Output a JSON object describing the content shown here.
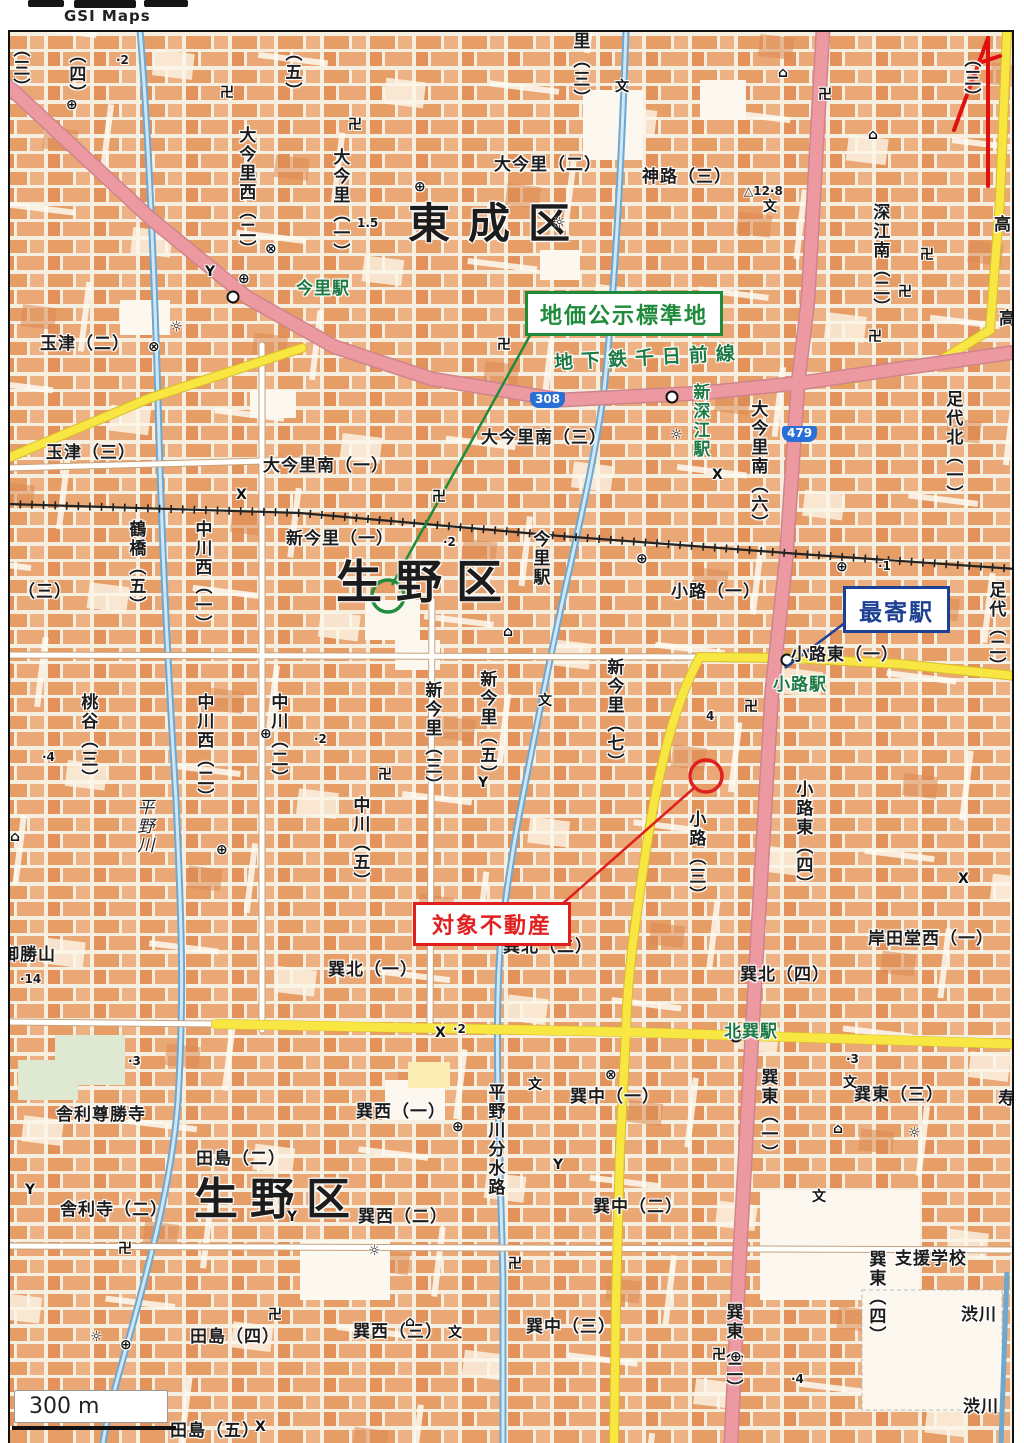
{
  "header": {
    "logo_text": "GSI Maps"
  },
  "annotations": {
    "standard_site": {
      "label": "地価公示標準地",
      "color": "#1f8b3b"
    },
    "nearest_station": {
      "label": "最寄駅",
      "color": "#1d3f94"
    },
    "subject_property": {
      "label": "対象不動産",
      "color": "#e01f1f"
    }
  },
  "scale_bar": {
    "label": "300 m"
  },
  "map": {
    "colors": {
      "major_road": "#ec99a2",
      "secondary_road": "#f8e643",
      "water": "#6fa8cf",
      "city_block": "#e79d66",
      "station_text": "#1e7a45",
      "annotation_green": "#1f8b3b",
      "annotation_navy": "#1d3f94",
      "annotation_red": "#e01f1f"
    },
    "ward_names": [
      "東成区",
      "生野区"
    ],
    "railway_line": "地下鉄千日前線",
    "route_shields": [
      "308",
      "479"
    ],
    "stations": [
      "今里駅",
      "新深江駅",
      "小路駅",
      "北巽駅"
    ],
    "labels": [
      {
        "t": "（三）",
        "x": 10,
        "y": 40,
        "c": "v"
      },
      {
        "t": "（四）",
        "x": 66,
        "y": 46,
        "c": "v"
      },
      {
        "t": "·2",
        "x": 116,
        "y": 54,
        "c": "spot"
      },
      {
        "t": "（五）",
        "x": 282,
        "y": 44,
        "c": "v"
      },
      {
        "t": "里（三）",
        "x": 570,
        "y": 32,
        "c": "v"
      },
      {
        "t": "（三）",
        "x": 961,
        "y": 50,
        "c": "v"
      },
      {
        "t": "大今里西（二）",
        "x": 236,
        "y": 126,
        "c": "v"
      },
      {
        "t": "大今里（一）",
        "x": 330,
        "y": 148,
        "c": "v"
      },
      {
        "t": "大今里（二）",
        "x": 494,
        "y": 156
      },
      {
        "t": "神路（三）",
        "x": 642,
        "y": 168
      },
      {
        "t": "△12·8",
        "x": 744,
        "y": 185,
        "c": "spot"
      },
      {
        "t": "東成区",
        "x": 408,
        "y": 201,
        "c": "big",
        "s": 42,
        "ls": 18
      },
      {
        "t": "1.5",
        "x": 357,
        "y": 217,
        "c": "spot"
      },
      {
        "t": "深江南（二）",
        "x": 870,
        "y": 203,
        "c": "v"
      },
      {
        "t": "高",
        "x": 994,
        "y": 216
      },
      {
        "t": "高",
        "x": 999,
        "y": 310
      },
      {
        "t": "今里駅",
        "x": 296,
        "y": 280,
        "c": "green"
      },
      {
        "t": "玉津（二）",
        "x": 40,
        "y": 335
      },
      {
        "t": "地下鉄千日前線",
        "x": 554,
        "y": 348,
        "c": "green",
        "s": 19,
        "ls": 8,
        "r": -3
      },
      {
        "t": "大今里南（三）",
        "x": 481,
        "y": 429
      },
      {
        "t": "新深江駅",
        "x": 690,
        "y": 383,
        "c": "green v"
      },
      {
        "t": "大今里南（六）",
        "x": 748,
        "y": 400,
        "c": "v"
      },
      {
        "t": "玉津（三）",
        "x": 46,
        "y": 444
      },
      {
        "t": "大今里南（一）",
        "x": 263,
        "y": 457
      },
      {
        "t": "足代北（一）",
        "x": 943,
        "y": 390,
        "c": "v"
      },
      {
        "t": "鶴橋（五）",
        "x": 126,
        "y": 520,
        "c": "v"
      },
      {
        "t": "中川西（一）",
        "x": 192,
        "y": 520,
        "c": "v"
      },
      {
        "t": "新今里（一）",
        "x": 286,
        "y": 530
      },
      {
        "t": "·2",
        "x": 443,
        "y": 536,
        "c": "spot"
      },
      {
        "t": "生野区",
        "x": 336,
        "y": 558,
        "c": "big",
        "s": 46,
        "ls": 14
      },
      {
        "t": "今里駅",
        "x": 530,
        "y": 530,
        "c": "v"
      },
      {
        "t": "（三）",
        "x": 18,
        "y": 583
      },
      {
        "t": "小路（一）",
        "x": 671,
        "y": 583
      },
      {
        "t": "·1",
        "x": 878,
        "y": 560,
        "c": "spot"
      },
      {
        "t": "足代（二）",
        "x": 986,
        "y": 581,
        "c": "v"
      },
      {
        "t": "小路東（一）",
        "x": 791,
        "y": 646
      },
      {
        "t": "小路駅",
        "x": 773,
        "y": 676,
        "c": "green"
      },
      {
        "t": "桃谷（三）",
        "x": 78,
        "y": 693,
        "c": "v"
      },
      {
        "t": "·4",
        "x": 42,
        "y": 751,
        "c": "spot"
      },
      {
        "t": "中川西（二）",
        "x": 194,
        "y": 693,
        "c": "v"
      },
      {
        "t": "中川（二）",
        "x": 268,
        "y": 693,
        "c": "v"
      },
      {
        "t": "新今里（三）",
        "x": 422,
        "y": 681,
        "c": "v"
      },
      {
        "t": "新今里（五）",
        "x": 477,
        "y": 670,
        "c": "v"
      },
      {
        "t": "新今里（七）",
        "x": 604,
        "y": 658,
        "c": "v"
      },
      {
        "t": "·2",
        "x": 314,
        "y": 733,
        "c": "spot"
      },
      {
        "t": "4",
        "x": 706,
        "y": 710,
        "c": "spot"
      },
      {
        "t": "平野川",
        "x": 134,
        "y": 798,
        "c": "river v"
      },
      {
        "t": "中川（五）",
        "x": 350,
        "y": 796,
        "c": "v"
      },
      {
        "t": "小路（三）",
        "x": 686,
        "y": 810,
        "c": "v"
      },
      {
        "t": "小路東（四）",
        "x": 793,
        "y": 780,
        "c": "v"
      },
      {
        "t": "御勝山",
        "x": 2,
        "y": 946
      },
      {
        "t": "·14",
        "x": 20,
        "y": 973,
        "c": "spot"
      },
      {
        "t": "巽北（二）",
        "x": 503,
        "y": 938
      },
      {
        "t": "巽北（一）",
        "x": 328,
        "y": 961
      },
      {
        "t": "巽北（四）",
        "x": 740,
        "y": 966
      },
      {
        "t": "岸田堂西（一）",
        "x": 868,
        "y": 930
      },
      {
        "t": "·2",
        "x": 453,
        "y": 1023,
        "c": "spot"
      },
      {
        "t": "北巽駅",
        "x": 724,
        "y": 1023,
        "c": "green"
      },
      {
        "t": "·3",
        "x": 846,
        "y": 1053,
        "c": "spot"
      },
      {
        "t": "·3",
        "x": 128,
        "y": 1055,
        "c": "spot"
      },
      {
        "t": "巽中（一）",
        "x": 570,
        "y": 1088
      },
      {
        "t": "巽東（三）",
        "x": 854,
        "y": 1086
      },
      {
        "t": "巽東（一）",
        "x": 758,
        "y": 1068,
        "c": "v"
      },
      {
        "t": "寿",
        "x": 998,
        "y": 1090
      },
      {
        "t": "巽西（一）",
        "x": 356,
        "y": 1103
      },
      {
        "t": "舎利尊勝寺",
        "x": 56,
        "y": 1106
      },
      {
        "t": "田島（二）",
        "x": 196,
        "y": 1150
      },
      {
        "t": "生野区",
        "x": 194,
        "y": 1176,
        "c": "big",
        "s": 44,
        "ls": 12
      },
      {
        "t": "巽西（二）",
        "x": 358,
        "y": 1208
      },
      {
        "t": "平野川分水路",
        "x": 485,
        "y": 1083,
        "c": "v"
      },
      {
        "t": "舎利寺（二）",
        "x": 60,
        "y": 1201
      },
      {
        "t": "巽中（二）",
        "x": 593,
        "y": 1198
      },
      {
        "t": "支援学校",
        "x": 895,
        "y": 1250
      },
      {
        "t": "巽東（四）",
        "x": 866,
        "y": 1250,
        "c": "v"
      },
      {
        "t": "巽東（二）",
        "x": 723,
        "y": 1303,
        "c": "v"
      },
      {
        "t": "渋川",
        "x": 961,
        "y": 1306
      },
      {
        "t": "田島（四）",
        "x": 190,
        "y": 1328
      },
      {
        "t": "巽西（三）",
        "x": 353,
        "y": 1323
      },
      {
        "t": "巽中（三）",
        "x": 526,
        "y": 1318
      },
      {
        "t": "·4",
        "x": 791,
        "y": 1373,
        "c": "spot"
      },
      {
        "t": "渋川",
        "x": 963,
        "y": 1398
      },
      {
        "t": "田島（五）",
        "x": 170,
        "y": 1422
      },
      {
        "t": "308",
        "x": 530,
        "y": 392,
        "c": "shield"
      },
      {
        "t": "479",
        "x": 782,
        "y": 426,
        "c": "shield"
      }
    ],
    "symbols": {
      "temple": {
        "glyph": "卍",
        "points": [
          [
            220,
            86
          ],
          [
            348,
            118
          ],
          [
            497,
            338
          ],
          [
            432,
            490
          ],
          [
            378,
            768
          ],
          [
            744,
            700
          ],
          [
            118,
            1242
          ],
          [
            268,
            1308
          ],
          [
            712,
            1348
          ],
          [
            920,
            248
          ],
          [
            898,
            285
          ],
          [
            818,
            88
          ],
          [
            868,
            330
          ],
          [
            508,
            1257
          ]
        ]
      },
      "school": {
        "glyph": "文",
        "points": [
          [
            615,
            80
          ],
          [
            763,
            200
          ],
          [
            538,
            694
          ],
          [
            528,
            1078
          ],
          [
            843,
            1076
          ],
          [
            812,
            1190
          ],
          [
            448,
            1326
          ]
        ]
      },
      "post-office": {
        "glyph": "⊕",
        "points": [
          [
            66,
            98
          ],
          [
            238,
            272
          ],
          [
            414,
            180
          ],
          [
            636,
            552
          ],
          [
            836,
            560
          ],
          [
            216,
            843
          ],
          [
            260,
            727
          ],
          [
            452,
            1120
          ],
          [
            730,
            1350
          ],
          [
            120,
            1338
          ]
        ]
      },
      "police-station": {
        "glyph": "⊗",
        "points": [
          [
            265,
            242
          ],
          [
            148,
            340
          ],
          [
            605,
            1068
          ]
        ]
      },
      "government": {
        "glyph": "☼",
        "points": [
          [
            553,
            216
          ],
          [
            170,
            320
          ],
          [
            670,
            428
          ],
          [
            908,
            1126
          ],
          [
            368,
            1244
          ],
          [
            90,
            1330
          ]
        ]
      },
      "fire-station": {
        "glyph": "Y",
        "points": [
          [
            205,
            265
          ],
          [
            478,
            776
          ],
          [
            553,
            1158
          ],
          [
            287,
            1210
          ],
          [
            25,
            1183
          ]
        ]
      },
      "facility": {
        "glyph": "⌂",
        "points": [
          [
            503,
            625
          ],
          [
            778,
            66
          ],
          [
            868,
            128
          ],
          [
            405,
            1315
          ],
          [
            833,
            1122
          ],
          [
            10,
            830
          ]
        ]
      },
      "police-box": {
        "glyph": "X",
        "points": [
          [
            236,
            488
          ],
          [
            652,
            305
          ],
          [
            958,
            872
          ],
          [
            435,
            1026
          ],
          [
            255,
            1420
          ],
          [
            712,
            468
          ]
        ]
      }
    }
  }
}
